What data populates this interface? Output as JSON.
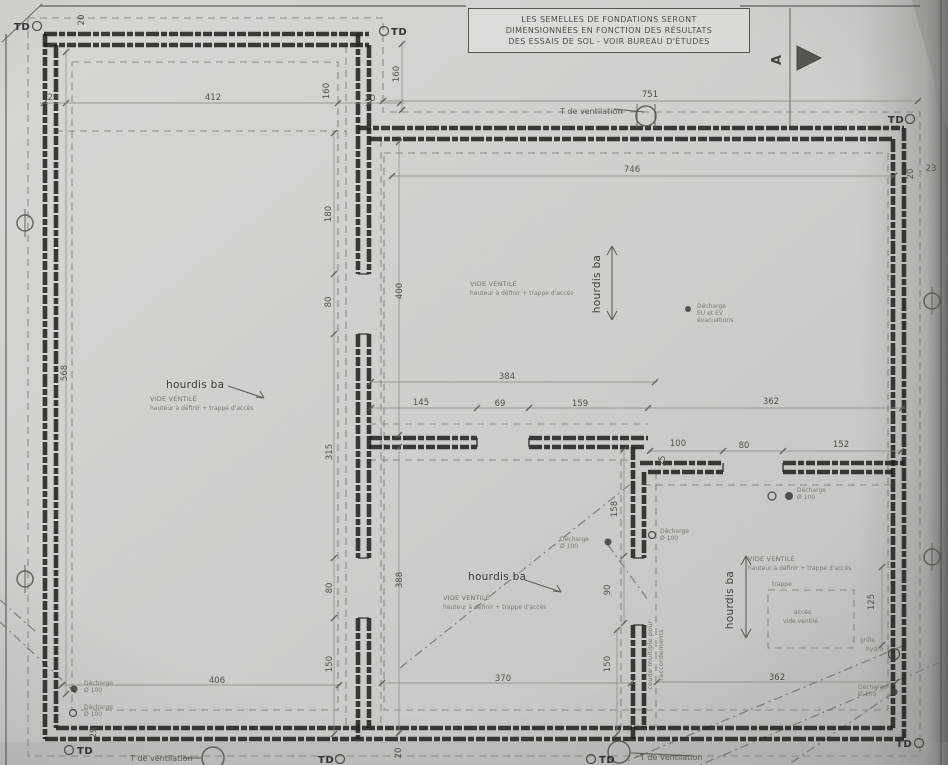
{
  "meta": {
    "title": "Plan de fondations (scan)"
  },
  "colors": {
    "paper": "#cfcfcb",
    "wall": "#23231f",
    "faint": "#7b7b76"
  },
  "note_box": {
    "lines": [
      "LES SEMELLES DE FONDATIONS SERONT",
      "DIMENSIONNÉES EN FONCTION DES RÉSULTATS",
      "DES ESSAIS DE SOL - VOIR BUREAU D'ÉTUDES"
    ]
  },
  "section_marker": {
    "label": "A"
  },
  "labels": [
    {
      "name": "hourdis-label-1",
      "text": "hourdis ba",
      "x": 166,
      "y": 388,
      "rot": 0,
      "cls": "t-lbl"
    },
    {
      "name": "hourdis-label-2",
      "text": "hourdis ba",
      "x": 600,
      "y": 284,
      "rot": -90,
      "cls": "t-lbl",
      "anchor": "middle"
    },
    {
      "name": "hourdis-label-3",
      "text": "hourdis ba",
      "x": 468,
      "y": 580,
      "rot": 0,
      "cls": "t-lbl"
    },
    {
      "name": "hourdis-label-4",
      "text": "hourdis ba",
      "x": 733,
      "y": 600,
      "rot": -90,
      "cls": "t-lbl",
      "anchor": "middle"
    },
    {
      "name": "vide-ventile-1a",
      "text": "VIDE VENTILÉ",
      "x": 150,
      "y": 401,
      "rot": 0,
      "cls": "t-sm"
    },
    {
      "name": "vide-ventile-1b",
      "text": "hauteur à définir + trappe d'accès",
      "x": 150,
      "y": 410,
      "rot": 0,
      "cls": "t-xs"
    },
    {
      "name": "vide-ventile-2a",
      "text": "VIDE VENTILÉ",
      "x": 470,
      "y": 286,
      "rot": 0,
      "cls": "t-sm"
    },
    {
      "name": "vide-ventile-2b",
      "text": "hauteur à définir + trappe d'accès",
      "x": 470,
      "y": 295,
      "rot": 0,
      "cls": "t-xs"
    },
    {
      "name": "vide-ventile-3a",
      "text": "VIDE VENTILÉ",
      "x": 443,
      "y": 600,
      "rot": 0,
      "cls": "t-sm"
    },
    {
      "name": "vide-ventile-3b",
      "text": "hauteur à définir + trappe d'accès",
      "x": 443,
      "y": 609,
      "rot": 0,
      "cls": "t-xs"
    },
    {
      "name": "vide-ventile-4a",
      "text": "VIDE VENTILÉ",
      "x": 748,
      "y": 561,
      "rot": 0,
      "cls": "t-sm"
    },
    {
      "name": "vide-ventile-4b",
      "text": "hauteur à définir + trappe d'accès",
      "x": 748,
      "y": 570,
      "rot": 0,
      "cls": "t-xs"
    },
    {
      "name": "t-ventilation-top",
      "text": "T de ventilation",
      "x": 560,
      "y": 114,
      "rot": 0,
      "cls": "t-tv"
    },
    {
      "name": "t-ventilation-bottom-left",
      "text": "T de ventilation",
      "x": 130,
      "y": 761,
      "rot": 0,
      "cls": "t-tv"
    },
    {
      "name": "t-ventilation-bottom-center",
      "text": "T de ventilation",
      "x": 640,
      "y": 760,
      "rot": 0,
      "cls": "t-tv"
    },
    {
      "name": "td-marker-top-left",
      "text": "TD",
      "x": 14,
      "y": 30,
      "rot": 0,
      "cls": "t-td"
    },
    {
      "name": "td-marker-top-mid",
      "text": "TD",
      "x": 391,
      "y": 35,
      "rot": 0,
      "cls": "t-td"
    },
    {
      "name": "td-marker-right-top",
      "text": "TD",
      "x": 888,
      "y": 123,
      "rot": 0,
      "cls": "t-td"
    },
    {
      "name": "td-marker-bottom-left",
      "text": "TD",
      "x": 77,
      "y": 754,
      "rot": 0,
      "cls": "t-td"
    },
    {
      "name": "td-marker-bottom-mid1",
      "text": "TD",
      "x": 318,
      "y": 763,
      "rot": 0,
      "cls": "t-td"
    },
    {
      "name": "td-marker-bottom-mid2",
      "text": "TD",
      "x": 599,
      "y": 763,
      "rot": 0,
      "cls": "t-td"
    },
    {
      "name": "td-marker-bottom-right",
      "text": "TD",
      "x": 896,
      "y": 747,
      "rot": 0,
      "cls": "t-td"
    },
    {
      "name": "decharge-1a",
      "text": "Décharge",
      "x": 84,
      "y": 685,
      "rot": 0,
      "cls": "t-xs"
    },
    {
      "name": "decharge-1b",
      "text": "Ø 100",
      "x": 84,
      "y": 692,
      "rot": 0,
      "cls": "t-xs"
    },
    {
      "name": "decharge-2a",
      "text": "Décharge",
      "x": 84,
      "y": 709,
      "rot": 0,
      "cls": "t-xs"
    },
    {
      "name": "decharge-2b",
      "text": "Ø 100",
      "x": 84,
      "y": 716,
      "rot": 0,
      "cls": "t-xs"
    },
    {
      "name": "decharge-3a",
      "text": "Décharge",
      "x": 697,
      "y": 308,
      "rot": 0,
      "cls": "t-xs"
    },
    {
      "name": "decharge-3b",
      "text": "EU et EV",
      "x": 697,
      "y": 315,
      "rot": 0,
      "cls": "t-xs"
    },
    {
      "name": "decharge-3c",
      "text": "évacuations",
      "x": 697,
      "y": 322,
      "rot": 0,
      "cls": "t-xs"
    },
    {
      "name": "decharge-4a",
      "text": "Décharge",
      "x": 560,
      "y": 541,
      "rot": 0,
      "cls": "t-xs"
    },
    {
      "name": "decharge-4b",
      "text": "Ø 100",
      "x": 560,
      "y": 548,
      "rot": 0,
      "cls": "t-xs"
    },
    {
      "name": "decharge-5a",
      "text": "Décharge",
      "x": 660,
      "y": 533,
      "rot": 0,
      "cls": "t-xs"
    },
    {
      "name": "decharge-5b",
      "text": "Ø 100",
      "x": 660,
      "y": 540,
      "rot": 0,
      "cls": "t-xs"
    },
    {
      "name": "decharge-6a",
      "text": "Décharge",
      "x": 797,
      "y": 492,
      "rot": 0,
      "cls": "t-xs"
    },
    {
      "name": "decharge-6b",
      "text": "Ø 100",
      "x": 797,
      "y": 499,
      "rot": 0,
      "cls": "t-xs"
    },
    {
      "name": "decharge-7a",
      "text": "Décharge",
      "x": 858,
      "y": 689,
      "rot": 0,
      "cls": "t-xs"
    },
    {
      "name": "decharge-7b",
      "text": "Ø 100",
      "x": 858,
      "y": 696,
      "rot": 0,
      "cls": "t-xs"
    },
    {
      "name": "grille-hydro-a",
      "text": "grille",
      "x": 860,
      "y": 642,
      "rot": 0,
      "cls": "t-xs"
    },
    {
      "name": "grille-hydro-b",
      "text": "hydro",
      "x": 866,
      "y": 651,
      "rot": 0,
      "cls": "t-xs"
    },
    {
      "name": "coude-multiple-a",
      "text": "coude multiple pour",
      "x": 652,
      "y": 655,
      "rot": -90,
      "cls": "t-sm",
      "anchor": "middle"
    },
    {
      "name": "coude-multiple-b",
      "text": "raccordements",
      "x": 663,
      "y": 655,
      "rot": -90,
      "cls": "t-sm",
      "anchor": "middle"
    },
    {
      "name": "trappe-label",
      "text": "trappe",
      "x": 772,
      "y": 586,
      "rot": 0,
      "cls": "t-xs"
    },
    {
      "name": "acces-label-a",
      "text": "accès",
      "x": 794,
      "y": 614,
      "rot": 0,
      "cls": "t-xs"
    },
    {
      "name": "acces-label-b",
      "text": "vide ventilé",
      "x": 783,
      "y": 623,
      "rot": 0,
      "cls": "t-xs"
    },
    {
      "name": "section-a-label",
      "text": "A",
      "x": 781,
      "y": 60,
      "rot": -90,
      "cls": "t-A",
      "anchor": "middle"
    }
  ],
  "dimensions": [
    {
      "text": "20",
      "x": 84,
      "y": 20,
      "rot": -90
    },
    {
      "text": "29",
      "x": 53,
      "y": 100,
      "rot": 0
    },
    {
      "text": "412",
      "x": 213,
      "y": 100,
      "rot": 0
    },
    {
      "text": "160",
      "x": 329,
      "y": 91,
      "rot": -90
    },
    {
      "text": "20",
      "x": 370,
      "y": 101,
      "rot": 0
    },
    {
      "text": "160",
      "x": 399,
      "y": 74,
      "rot": -90
    },
    {
      "text": "751",
      "x": 650,
      "y": 97,
      "rot": 0
    },
    {
      "text": "746",
      "x": 632,
      "y": 172,
      "rot": 0
    },
    {
      "text": "20",
      "x": 913,
      "y": 174,
      "rot": -90
    },
    {
      "text": "23",
      "x": 931,
      "y": 171,
      "rot": 0
    },
    {
      "text": "180",
      "x": 331,
      "y": 214,
      "rot": -90
    },
    {
      "text": "80",
      "x": 331,
      "y": 302,
      "rot": -90
    },
    {
      "text": "400",
      "x": 402,
      "y": 291,
      "rot": -90
    },
    {
      "text": "315",
      "x": 332,
      "y": 452,
      "rot": -90
    },
    {
      "text": "388",
      "x": 402,
      "y": 580,
      "rot": -90
    },
    {
      "text": "80",
      "x": 332,
      "y": 588,
      "rot": -90
    },
    {
      "text": "150",
      "x": 332,
      "y": 664,
      "rot": -90
    },
    {
      "text": "568",
      "x": 67,
      "y": 373,
      "rot": -90
    },
    {
      "text": "384",
      "x": 507,
      "y": 379,
      "rot": 0
    },
    {
      "text": "145",
      "x": 421,
      "y": 405,
      "rot": 0
    },
    {
      "text": "69",
      "x": 500,
      "y": 406,
      "rot": 0
    },
    {
      "text": "159",
      "x": 580,
      "y": 406,
      "rot": 0
    },
    {
      "text": "362",
      "x": 771,
      "y": 404,
      "rot": 0
    },
    {
      "text": "100",
      "x": 678,
      "y": 446,
      "rot": 0
    },
    {
      "text": "25",
      "x": 665,
      "y": 461,
      "rot": -90
    },
    {
      "text": "80",
      "x": 744,
      "y": 448,
      "rot": 0
    },
    {
      "text": "152",
      "x": 841,
      "y": 447,
      "rot": 0
    },
    {
      "text": "158",
      "x": 617,
      "y": 509,
      "rot": -90
    },
    {
      "text": "90",
      "x": 610,
      "y": 590,
      "rot": -90
    },
    {
      "text": "125",
      "x": 874,
      "y": 602,
      "rot": -90
    },
    {
      "text": "406",
      "x": 217,
      "y": 683,
      "rot": 0
    },
    {
      "text": "370",
      "x": 503,
      "y": 681,
      "rot": 0
    },
    {
      "text": "362",
      "x": 777,
      "y": 680,
      "rot": 0
    },
    {
      "text": "150",
      "x": 610,
      "y": 664,
      "rot": -90
    },
    {
      "text": "29",
      "x": 96,
      "y": 733,
      "rot": -90
    },
    {
      "text": "20",
      "x": 401,
      "y": 753,
      "rot": -90
    }
  ]
}
